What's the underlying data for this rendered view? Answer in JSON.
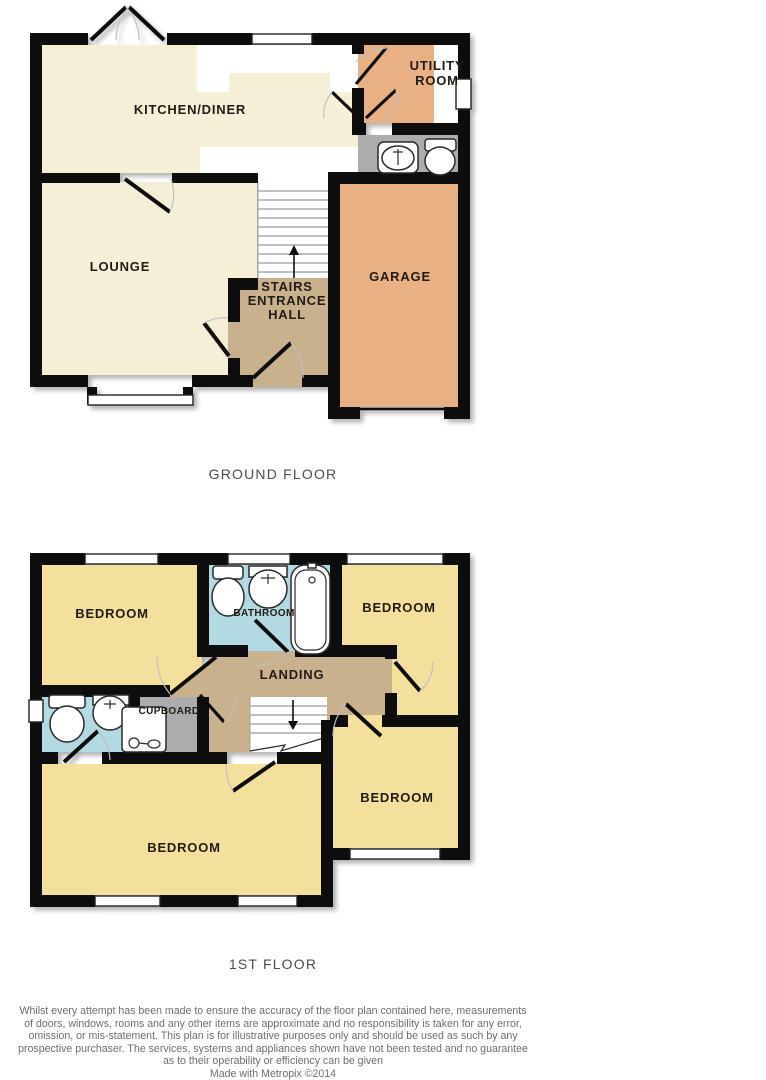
{
  "palette": {
    "wall": "#111111",
    "room_cream": "#F6EFD8",
    "room_yellow": "#F3E09C",
    "room_orange": "#E9B083",
    "hall_tan": "#C9B18E",
    "bathroom_blue": "#B3D9E3",
    "cupboard_gray": "#ACACAC",
    "caption_text": "#4d4d4d",
    "disclaimer_text": "#6e6e6e",
    "label_text": "#201a12"
  },
  "ground_floor": {
    "caption": "GROUND FLOOR",
    "rooms": {
      "kitchen_diner": "KITCHEN/DINER",
      "utility_line1": "UTILITY",
      "utility_line2": "ROOM",
      "lounge": "LOUNGE",
      "hall_line1": "STAIRS",
      "hall_line2": "ENTRANCE",
      "hall_line3": "HALL",
      "garage": "GARAGE"
    }
  },
  "first_floor": {
    "caption": "1ST FLOOR",
    "rooms": {
      "bedroom_top_left": "BEDROOM",
      "bathroom": "BATHROOM",
      "bedroom_top_right": "BEDROOM",
      "landing": "LANDING",
      "cupboard": "CUPBOARD",
      "bedroom_bottom_left": "BEDROOM",
      "bedroom_bottom_right": "BEDROOM"
    }
  },
  "footer": {
    "disclaimer_lines": [
      "Whilst every attempt has been made to ensure the accuracy of the floor plan contained here, measurements",
      "of doors, windows, rooms and any other items are approximate and no responsibility is taken for any error,",
      "omission, or mis-statement. This plan is for illustrative purposes only and should be used as such by any",
      "prospective purchaser. The services, systems and appliances shown have not been tested and no guarantee",
      "as to their operability or efficiency can be given"
    ],
    "credit": "Made with Metropix ©2014"
  }
}
